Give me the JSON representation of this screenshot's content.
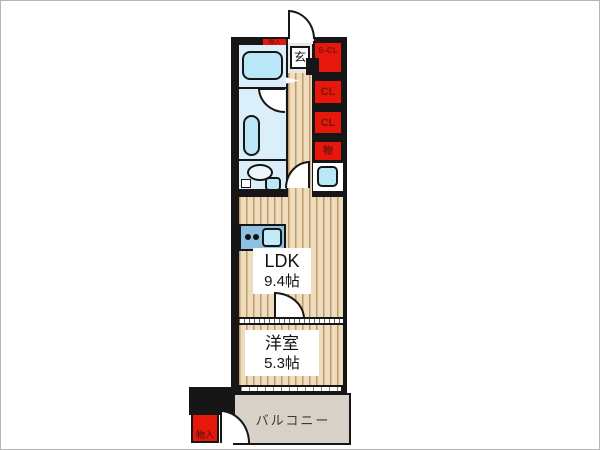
{
  "colors": {
    "wall": "#161616",
    "storage_red": "#e8170b",
    "storage_text": "#7a150c",
    "water_room": "#daeffa",
    "fixture_blue": "#b9e7f8",
    "kitchen_counter": "#8fc2e1",
    "wood_floor": "#eedcbf",
    "wood_line": "#bf9a66",
    "balcony_floor": "#d8d1c8",
    "genkan_tile": "#e9e7e4"
  },
  "rooms": {
    "ldk": {
      "name": "LDK",
      "size": "9.4帖"
    },
    "bedroom": {
      "name": "洋室",
      "size": "5.3帖"
    },
    "balcony": {
      "name": "バルコニー"
    },
    "entrance": {
      "name": "玄"
    }
  },
  "storage": {
    "entry_small": "物入",
    "shoes_closet": "S-CL",
    "closet_upper": "CL",
    "closet_lower": "CL",
    "storage_mono": "物",
    "storage_balcony": "物入"
  }
}
